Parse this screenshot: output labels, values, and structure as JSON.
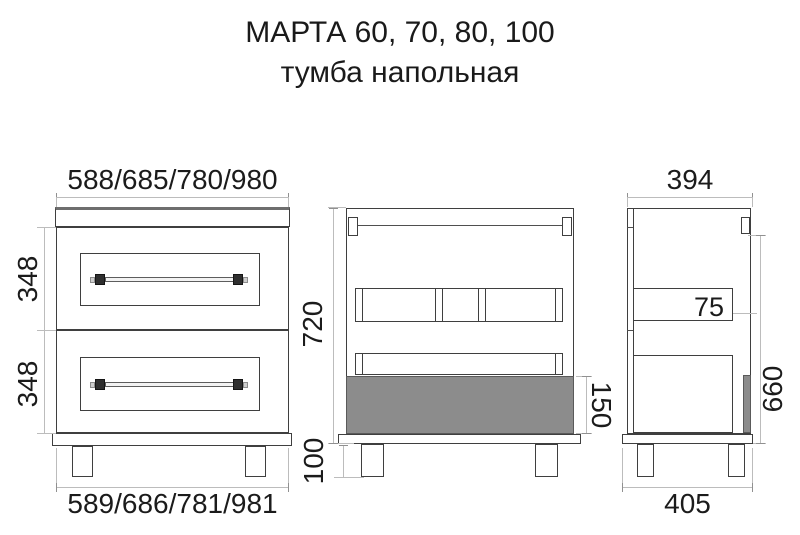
{
  "title": {
    "line1": "МАРТА 60, 70, 80, 100",
    "line2": "тумба напольная"
  },
  "front_view": {
    "top_width": "588/685/780/980",
    "upper_drawer_height": "348",
    "lower_drawer_height": "348",
    "bottom_width": "589/686/781/981"
  },
  "section_view": {
    "body_height": "720",
    "drawer_panel_height": "150",
    "leg_height": "100"
  },
  "side_view": {
    "top_depth": "394",
    "rail_height": "75",
    "side_height": "660",
    "bottom_depth": "405"
  },
  "colors": {
    "outline": "#3f3f3f",
    "dimension_line": "#bcbcbc",
    "panel_gray_fill": "#8c8c8c",
    "text": "#1b1b1b"
  }
}
